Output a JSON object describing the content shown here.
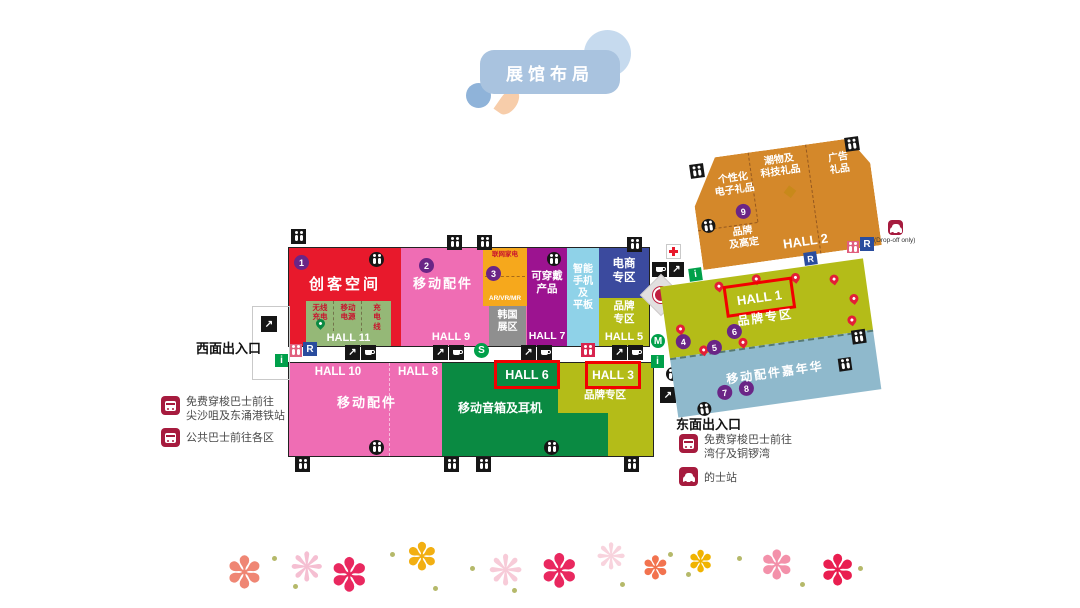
{
  "title": "展馆布局",
  "entrances": {
    "west": "西面出入口",
    "east": "东面出入口"
  },
  "legend_west": {
    "shuttle": "免费穿梭巴士前往\n尖沙咀及东涌港铁站",
    "public_bus": "公共巴士前往各区"
  },
  "legend_east": {
    "shuttle": "免费穿梭巴士前往\n湾仔及铜锣湾",
    "taxi": "的士站"
  },
  "halls": {
    "h1": "HALL 1",
    "h2": "HALL 2",
    "h3": "HALL 3",
    "h5": "HALL 5",
    "h6": "HALL 6",
    "h7": "HALL 7",
    "h8": "HALL 8",
    "h9": "HALL 9",
    "h10": "HALL 10",
    "h11": "HALL 11"
  },
  "zones": {
    "maker": "创客空间",
    "mobile_acc_top": "移动配件",
    "iot_home": "联网家电",
    "ar_vr": "AR/VR/MR",
    "korea": "韩国\n展区",
    "wearables": "可穿戴\n产品",
    "phones_tablets": "智能\n手机\n及\n平板",
    "ecommerce": "电商\n专区",
    "brand_h5": "品牌\n专区",
    "wireless_charge": "无线\n充电",
    "power_bank": "移动\n电源",
    "charge_cable": "充\n电\n线",
    "mobile_acc_bottom": "移动配件",
    "speakers": "移动音箱及耳机",
    "brand_h3": "品牌专区",
    "gifts_personal": "个性化\n电子礼品",
    "gifts_tech": "潮物及\n科技礼品",
    "gifts_ad": "广告\n礼品",
    "brand_custom": "品牌\n及高定",
    "brand_h1": "品牌专区",
    "carnival": "移动配件嘉年华"
  },
  "badges": [
    "1",
    "2",
    "3",
    "4",
    "5",
    "6",
    "7",
    "8",
    "9",
    "10"
  ],
  "icons": {
    "r": "R",
    "s": "S",
    "m": "M",
    "i": "i",
    "dropoff_note": "(Drop-off only)"
  },
  "colors": {
    "title_bubble": "#a9c3df",
    "red_hall": "#e8192c",
    "pink_hall": "#ef6db4",
    "orange_zone": "#f6a81c",
    "purple_hall": "#9c1390",
    "sky_zone": "#8fd2e8",
    "indigo_zone": "#3b4a9e",
    "olive_zone": "#b4bc18",
    "green_hall": "#0a8a42",
    "hall11_green": "#95b877",
    "korea_gray": "#8f8f8f",
    "hall2_orange": "#d4882a",
    "hall1_blue": "#8fb9cc",
    "badge_purple": "#6a2586",
    "highlight_red": "#f20000",
    "legend_maroon": "#a61b3e",
    "transit_green": "#00a04a",
    "r_blue": "#2a4d9e"
  },
  "decor": {
    "flowers": [
      {
        "x": 226,
        "y": 552,
        "s": 44,
        "c": "#ef8674",
        "g": "✽"
      },
      {
        "x": 290,
        "y": 548,
        "s": 40,
        "c": "#f5bfd2",
        "g": "❋"
      },
      {
        "x": 330,
        "y": 552,
        "s": 46,
        "c": "#e9285f",
        "g": "✽"
      },
      {
        "x": 406,
        "y": 538,
        "s": 38,
        "c": "#f2af12",
        "g": "✽"
      },
      {
        "x": 488,
        "y": 550,
        "s": 42,
        "c": "#f7cbd8",
        "g": "❋"
      },
      {
        "x": 540,
        "y": 548,
        "s": 46,
        "c": "#e9285f",
        "g": "✽"
      },
      {
        "x": 596,
        "y": 540,
        "s": 36,
        "c": "#f8d3dd",
        "g": "❋"
      },
      {
        "x": 642,
        "y": 552,
        "s": 32,
        "c": "#f2734f",
        "g": "✽"
      },
      {
        "x": 688,
        "y": 548,
        "s": 30,
        "c": "#f0b301",
        "g": "✽"
      },
      {
        "x": 760,
        "y": 546,
        "s": 40,
        "c": "#f391aa",
        "g": "✽"
      },
      {
        "x": 820,
        "y": 550,
        "s": 42,
        "c": "#e91e50",
        "g": "✽"
      }
    ],
    "dots": [
      {
        "x": 272,
        "y": 556
      },
      {
        "x": 293,
        "y": 584
      },
      {
        "x": 390,
        "y": 552
      },
      {
        "x": 433,
        "y": 586
      },
      {
        "x": 470,
        "y": 566
      },
      {
        "x": 512,
        "y": 588
      },
      {
        "x": 620,
        "y": 582
      },
      {
        "x": 668,
        "y": 552
      },
      {
        "x": 686,
        "y": 572
      },
      {
        "x": 737,
        "y": 556
      },
      {
        "x": 800,
        "y": 582
      },
      {
        "x": 858,
        "y": 566
      }
    ],
    "hall1_pins": [
      {
        "x": 54,
        "y": 3
      },
      {
        "x": 92,
        "y": 1
      },
      {
        "x": 131,
        "y": 5
      },
      {
        "x": 169,
        "y": 12
      },
      {
        "x": 186,
        "y": 34
      },
      {
        "x": 10,
        "y": 40
      },
      {
        "x": 30,
        "y": 64
      },
      {
        "x": 70,
        "y": 62
      },
      {
        "x": 181,
        "y": 55
      }
    ]
  }
}
